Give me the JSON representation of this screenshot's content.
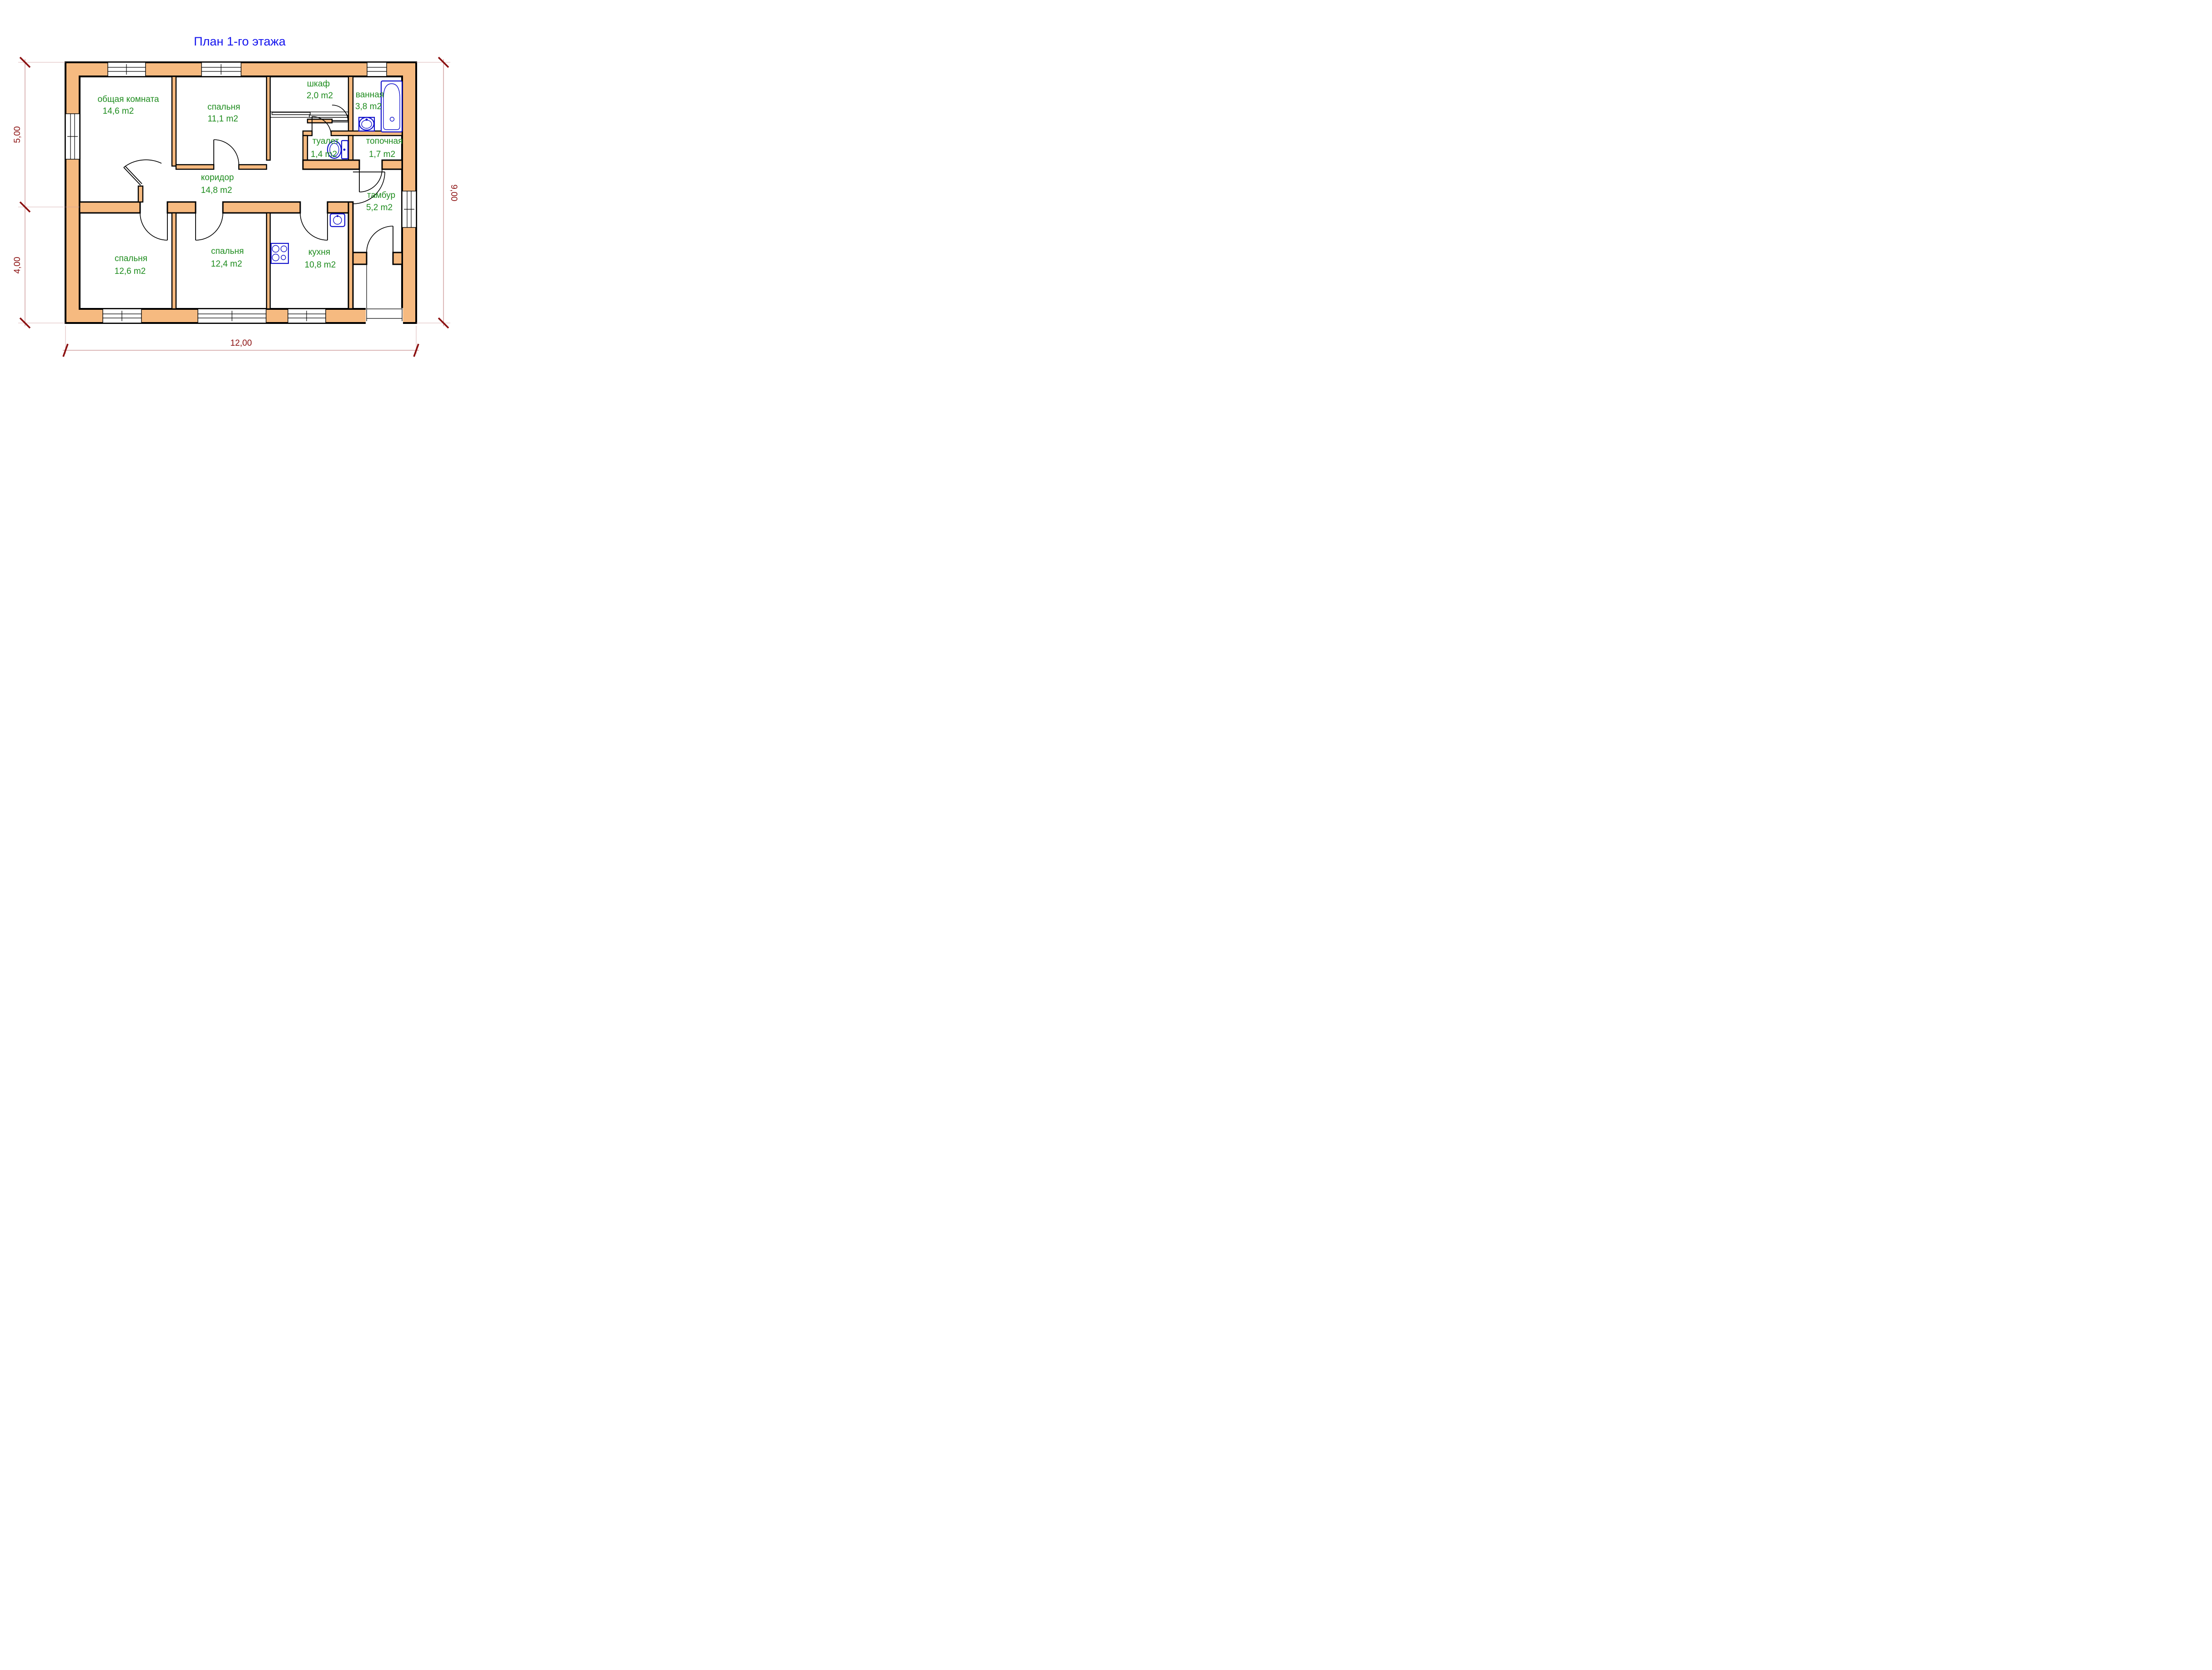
{
  "title": "План 1-го этажа",
  "colors": {
    "wall_fill": "#F6BA80",
    "wall_outline": "#000000",
    "room_label_green": "#1E8C1E",
    "title_blue": "#1414EE",
    "dimension_red": "#8B1010",
    "fixture_blue": "#1111CC"
  },
  "rooms": [
    {
      "name": "общая комната",
      "area": "14,6 m2"
    },
    {
      "name": "спальня",
      "area": "11,1 m2"
    },
    {
      "name": "шкаф",
      "area": "2,0 m2"
    },
    {
      "name": "ванная",
      "area": "3,8 m2"
    },
    {
      "name": "туалет",
      "area": "1,4 m2"
    },
    {
      "name": "топочная",
      "area": "1,7 m2"
    },
    {
      "name": "коридор",
      "area": "14,8 m2"
    },
    {
      "name": "тамбур",
      "area": "5,2 m2"
    },
    {
      "name": "спальня",
      "area": "12,6 m2"
    },
    {
      "name": "спальня",
      "area": "12,4 m2"
    },
    {
      "name": "кухня",
      "area": "10,8 m2"
    }
  ],
  "dimensions": {
    "left_top": "5,00",
    "left_bottom": "4,00",
    "right": "9,00",
    "bottom": "12,00"
  },
  "fixtures": [
    "bathtub",
    "bath-sink",
    "toilet",
    "kitchen-sink",
    "stove"
  ]
}
